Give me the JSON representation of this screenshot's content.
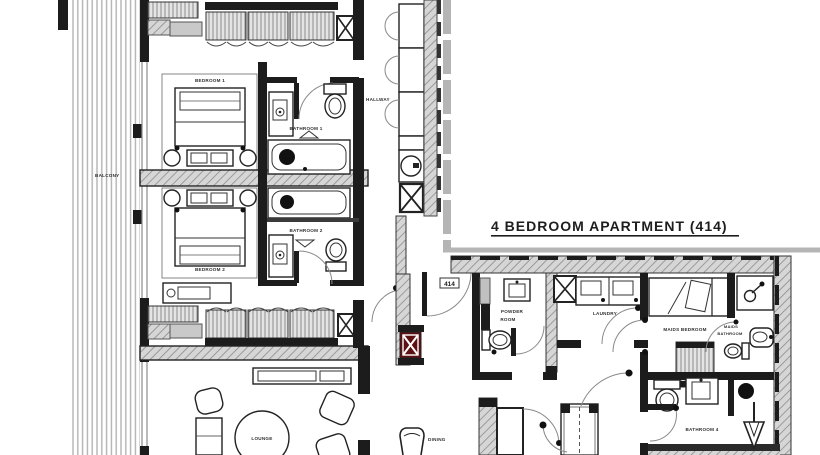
{
  "title": "4 BEDROOM APARTMENT (414)",
  "unit_tag": "414",
  "rooms": {
    "balcony": "BALCONY",
    "bedroom1": "BEDROOM 1",
    "bedroom2": "BEDROOM 2",
    "bathroom1": "BATHROOM 1",
    "bathroom2": "BATHROOM 2",
    "hallway": "HALLWAY",
    "lounge": "LOUNGE",
    "powder_line1": "POWDER",
    "powder_line2": "ROOM",
    "laundry": "LAUNDRY",
    "maids_bedroom": "MAIDS BEDROOM",
    "maids_bath_line1": "MAIDS",
    "maids_bath_line2": "BATHROOM",
    "bathroom4": "BATHROOM 4",
    "dining": "DINING"
  },
  "colors": {
    "ink": "#1c1c1c",
    "wall_hatch": "#8b8b8b",
    "hatch_bg": "#d6d6d6",
    "balcony_stripe": "#b3b3b3",
    "corridor_gray": "#b5b5b5",
    "shaft_red": "#5d1113",
    "label": "#2f2f2f",
    "background": "#ffffff"
  }
}
